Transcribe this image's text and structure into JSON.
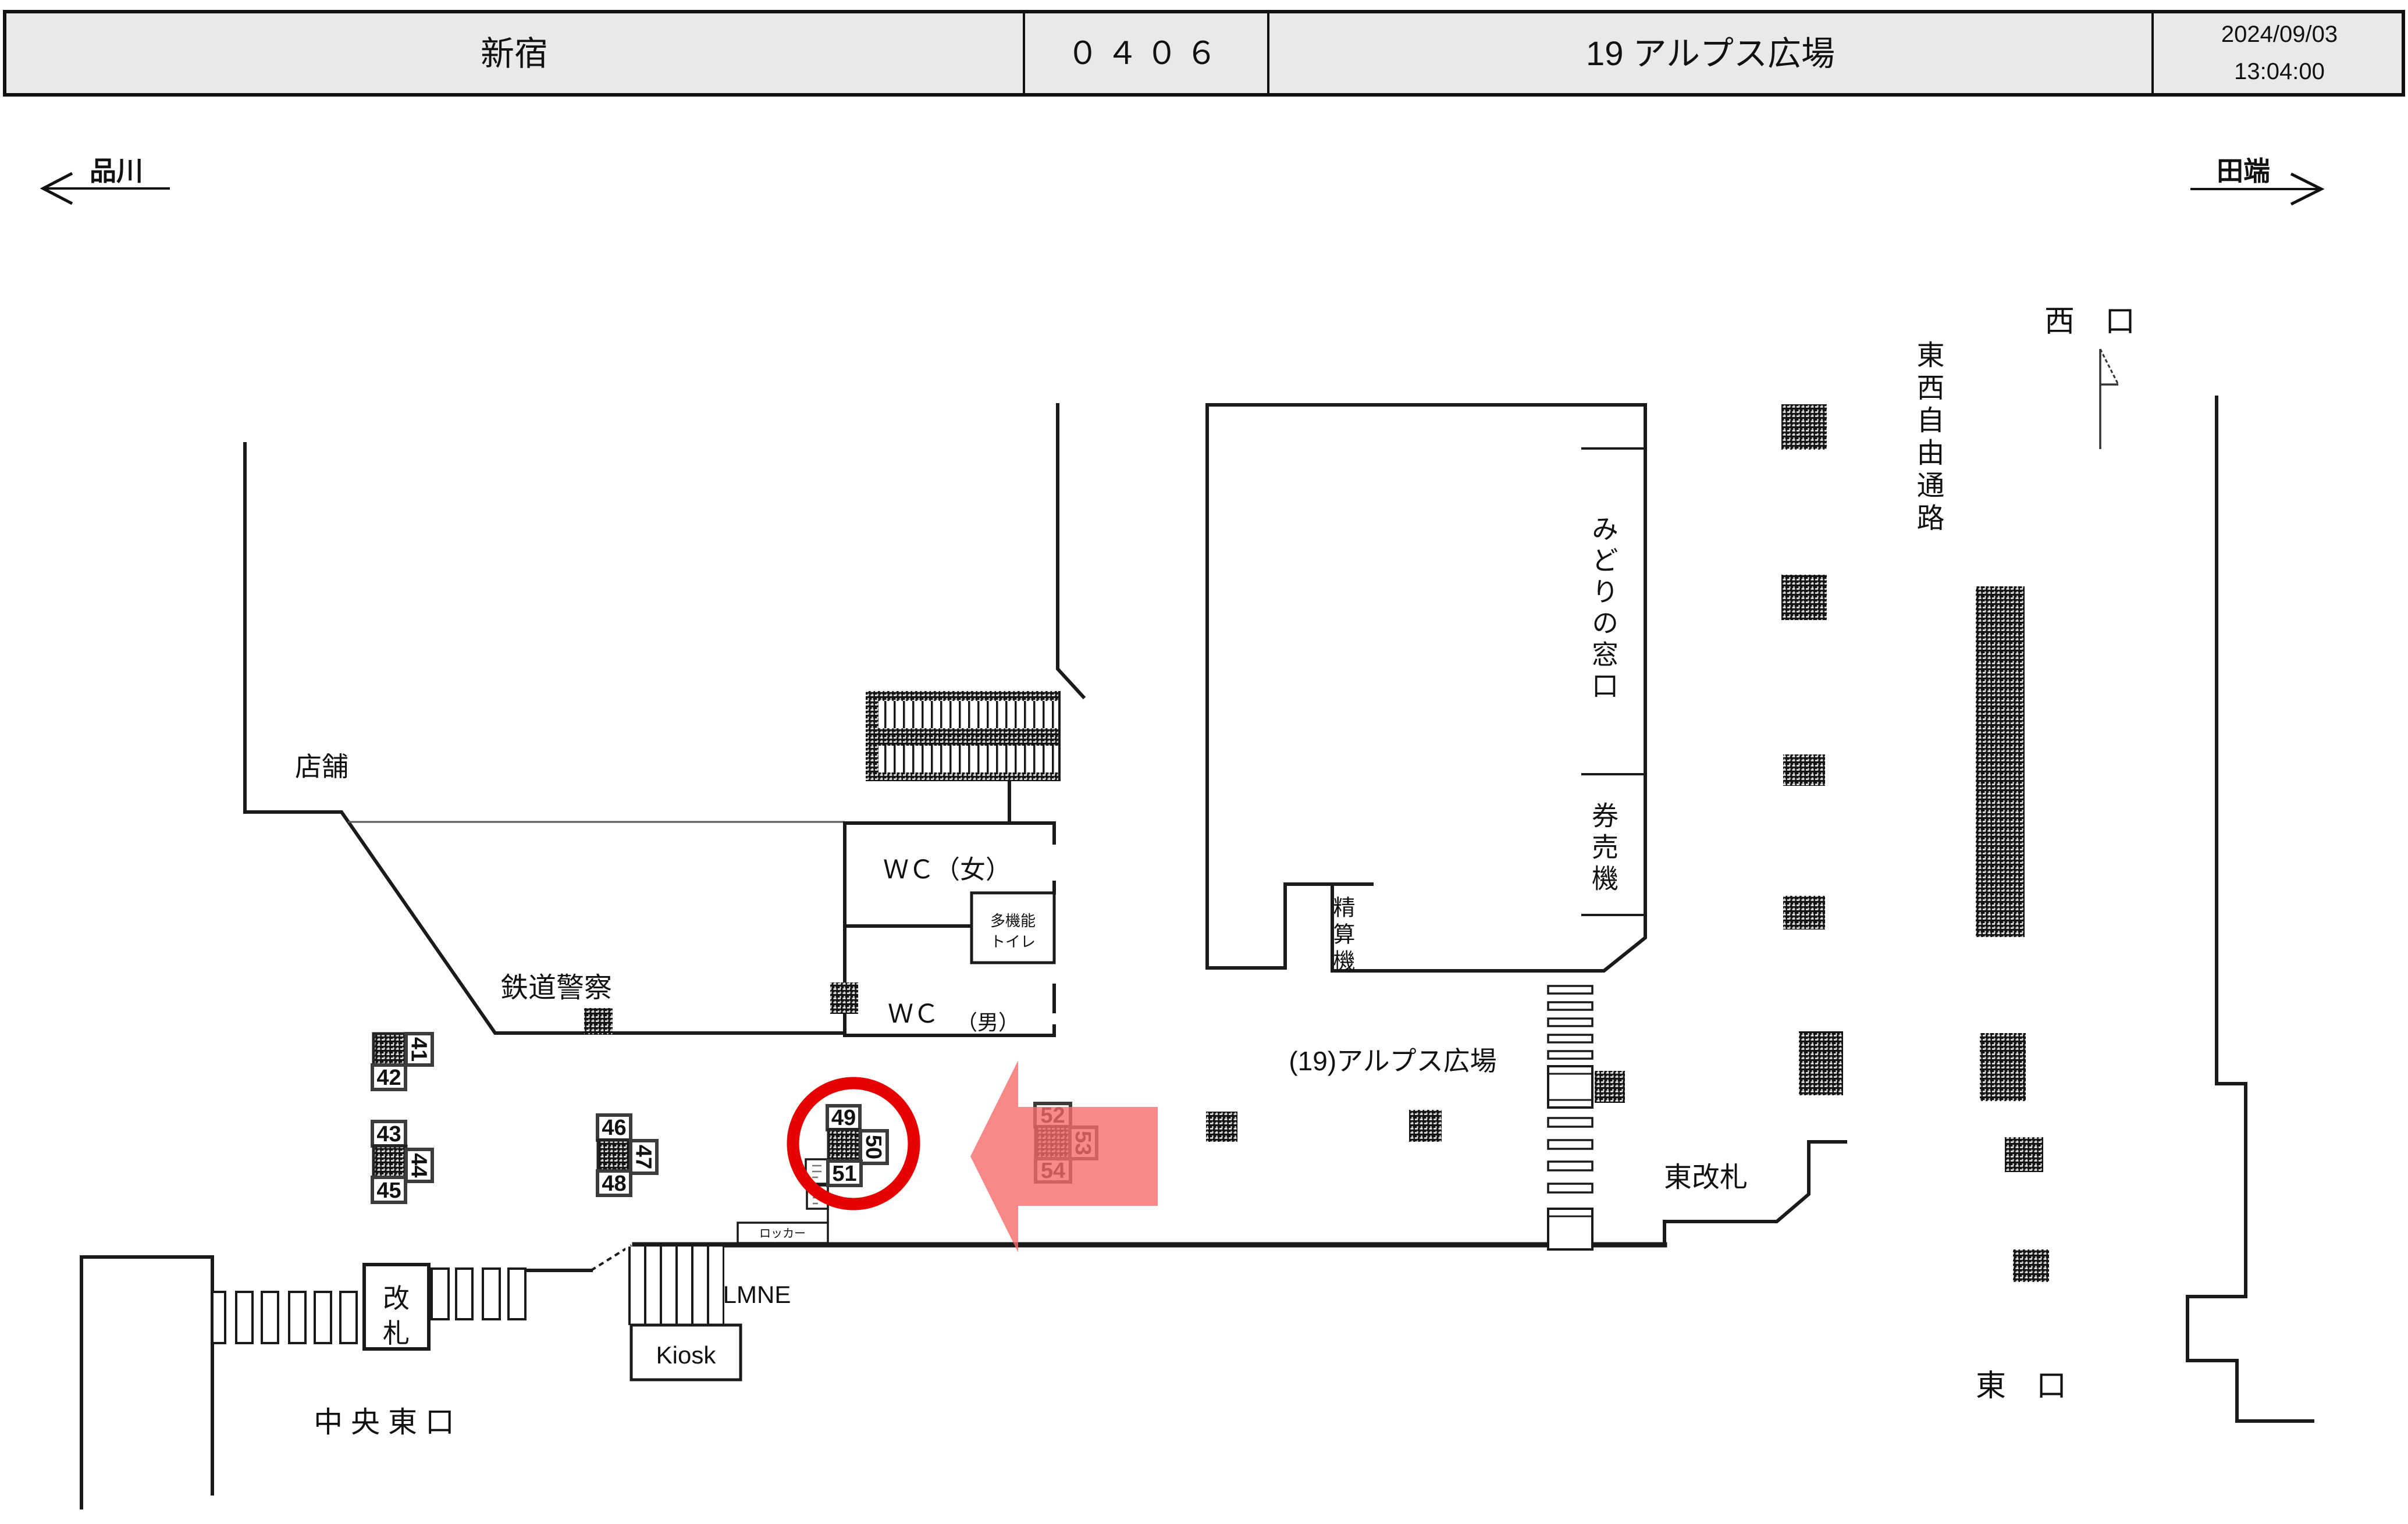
{
  "header": {
    "station": "新宿",
    "code": "０４０６",
    "title": "19 アルプス広場",
    "date": "2024/09/03",
    "time": "13:04:00"
  },
  "directions": {
    "left": "品川",
    "right": "田端"
  },
  "labels": {
    "west_exit": "西　口",
    "corridor": "東西自由通路",
    "midori_window": "みどりの窓口",
    "ticket_machines": "券売機",
    "fare_adjustment": "精算機",
    "shops": "店舗",
    "railway_police": "鉄道警察",
    "wc_women": "ＷＣ（女）",
    "multi_toilet_line1": "多機能",
    "multi_toilet_line2": "トイレ",
    "wc_men": "ＷＣ",
    "wc_men_suffix": "（男）",
    "plaza": "(19)アルプス広場",
    "east_gate": "東改札",
    "gate_line1": "改",
    "gate_line2": "札",
    "locker": "ロッカー",
    "lmne": "LMNE",
    "kiosk": "Kiosk",
    "central_east_exit": "中 央 東 口",
    "east_exit": "東　口"
  },
  "ads": [
    {
      "num": "41",
      "rotated": true
    },
    {
      "num": "42",
      "rotated": false
    },
    {
      "num": "43",
      "rotated": false
    },
    {
      "num": "44",
      "rotated": true
    },
    {
      "num": "45",
      "rotated": false
    },
    {
      "num": "46",
      "rotated": false
    },
    {
      "num": "47",
      "rotated": true
    },
    {
      "num": "48",
      "rotated": false
    },
    {
      "num": "49",
      "rotated": false
    },
    {
      "num": "50",
      "rotated": true
    },
    {
      "num": "51",
      "rotated": false
    },
    {
      "num": "52",
      "rotated": false
    },
    {
      "num": "53",
      "rotated": true
    },
    {
      "num": "54",
      "rotated": false
    }
  ],
  "highlight": {
    "circled_spots": "49-51",
    "arrow_spots": "52-54",
    "circle_color": "#e60000",
    "arrow_color": "#f76c6c"
  },
  "colors": {
    "wall": "#1a1a1a",
    "header_bg": "#e9e9e9"
  }
}
